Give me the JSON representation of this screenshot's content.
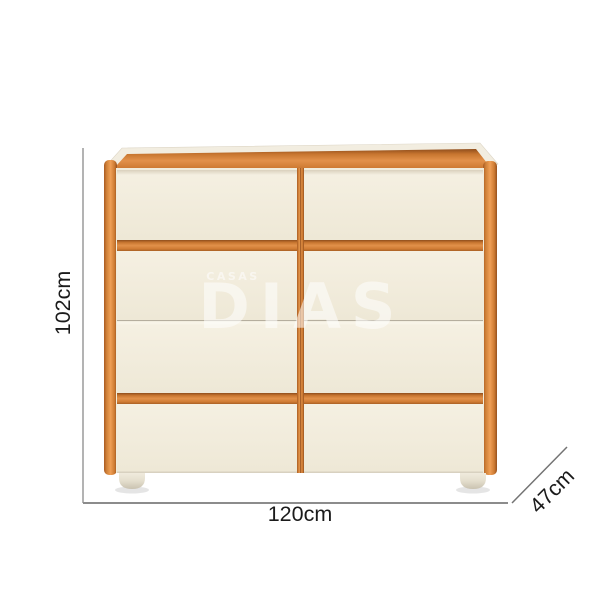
{
  "watermark": {
    "line1": "CASAS",
    "line2": "DIAS",
    "color": "#ffffff"
  },
  "dimensions": {
    "height": {
      "label": "102cm"
    },
    "width": {
      "label": "120cm"
    },
    "depth": {
      "label": "47cm"
    }
  },
  "furniture": {
    "type": "chest-of-drawers",
    "drawer_rows": 4,
    "drawer_columns": 2,
    "colors": {
      "frame_wood": "#d9823c",
      "frame_wood_dark": "#9c5420",
      "frame_wood_light": "#f0a35a",
      "drawer_front": "#f1ecdb",
      "top_surface": "#f2ede0",
      "feet": "#ebe5d6",
      "dimension_line": "#9a9a9a",
      "dimension_text": "#1b1b1b"
    }
  }
}
